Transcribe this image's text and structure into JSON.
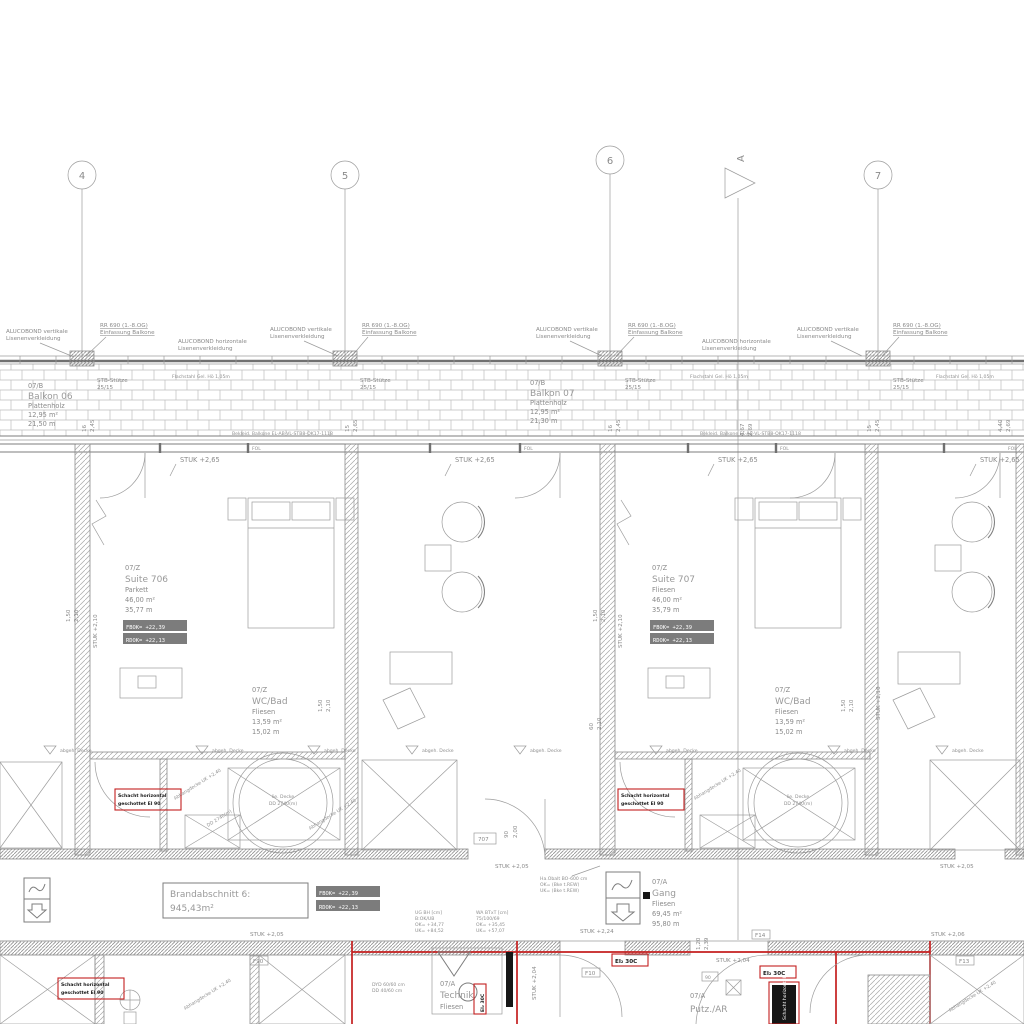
{
  "drawing": {
    "grid_markers": [
      "4",
      "5",
      "6",
      "7"
    ],
    "section_marker": "A",
    "facade": {
      "alucobond_v1": "ALUCOBOND vertikale",
      "alucobond_v2": "Lisenenverkleidung",
      "rr690_1": "RR 690 (1.-8.OG)",
      "rr690_2": "Einfassung Balkone",
      "alucobond_h1": "ALUCOBOND horizontale",
      "alucobond_h2": "Lisenenverkleidung",
      "column_1": "STB-Stütze",
      "column_2": "25/15",
      "railing": "Flachstahl Gel. Hö 1,05m",
      "slab_edge": "Bekleid. Balkone EL-AB-VL-STB8-OK17-1118",
      "window_tag": "FOL"
    },
    "rooms": {
      "balkon06": {
        "nr": "07/B",
        "name": "Balkon 06",
        "finish": "Plattenholz",
        "area": "12,95 m²",
        "perim": "21,50 m"
      },
      "balkon07": {
        "nr": "07/B",
        "name": "Balkon 07",
        "finish": "Plattenholz",
        "area": "12,95 m²",
        "perim": "21,30 m"
      },
      "suite706": {
        "nr": "07/Z",
        "name": "Suite 706",
        "finish": "Parkett",
        "area": "46,00 m²",
        "perim": "35,77 m"
      },
      "suite707": {
        "nr": "07/Z",
        "name": "Suite 707",
        "finish": "Fliesen",
        "area": "46,00 m²",
        "perim": "35,79 m"
      },
      "wcbad": {
        "nr": "07/Z",
        "name": "WC/Bad",
        "finish": "Fliesen",
        "area": "13,59 m²",
        "perim": "15,02 m"
      },
      "gang": {
        "nr": "07/A",
        "name": "Gang",
        "finish": "Fliesen",
        "area": "69,45 m²",
        "perim": "95,80 m"
      },
      "technik": {
        "nr": "07/A",
        "name": "Technik",
        "finish": "Fliesen"
      },
      "putz": {
        "nr": "07/A",
        "name": "Putz./AR"
      }
    },
    "levels": {
      "fbok": "FBOK= +22,39",
      "rdok": "RDOK= +22,13"
    },
    "heights": {
      "stuk265": "STUK +2,65",
      "stuk210": "STUK +2,10",
      "stuk205": "STUK +2,05",
      "stuk204": "STUK +2,04",
      "stuk206": "STUK +2,06",
      "stuk224": "STUK +2,24"
    },
    "fire": {
      "brand1": "Brandabschnitt 6:",
      "brand2": "945,43m²",
      "schacht1": "Schacht horizontal",
      "schacht2": "geschottet EI 90",
      "door_tag": "EI₂ 30C",
      "tags": [
        "F90",
        "F10",
        "F14",
        "F13"
      ]
    },
    "ceiling": {
      "abgeh": "abgeh. Decke",
      "abhang": "Abhangdecke UK +2,40",
      "dd": "DD 2740(m)",
      "lie": "lie. Decke"
    },
    "doors": {
      "nr707": "707",
      "w90": "90",
      "h200": "2,00"
    },
    "dims": {
      "d150": "1,50",
      "d210": "2,10",
      "d60": "60",
      "d16": "16",
      "d245": "2,45",
      "d15": "15",
      "d265": "2,65",
      "d467": "4,67",
      "d269": "2,69",
      "d120": "1,20",
      "d239": "2,39",
      "d440": "4,40"
    },
    "tags": {
      "t1": [
        "UG BH [cm]",
        "B:OK/UB",
        "OK= +34,77",
        "UK= +84,52"
      ],
      "t2": [
        "WA BTxT [cm]",
        "75/100/69",
        "OK= +35,45",
        "UK= +57,07"
      ],
      "t3": [
        "Ha.Obalt BO-600 cm",
        "OK= (Bke t.REW)",
        "UK= (Bke t.REW)"
      ],
      "t4": [
        "DYD 60/60 cm",
        "DD 40/60 cm"
      ]
    }
  }
}
